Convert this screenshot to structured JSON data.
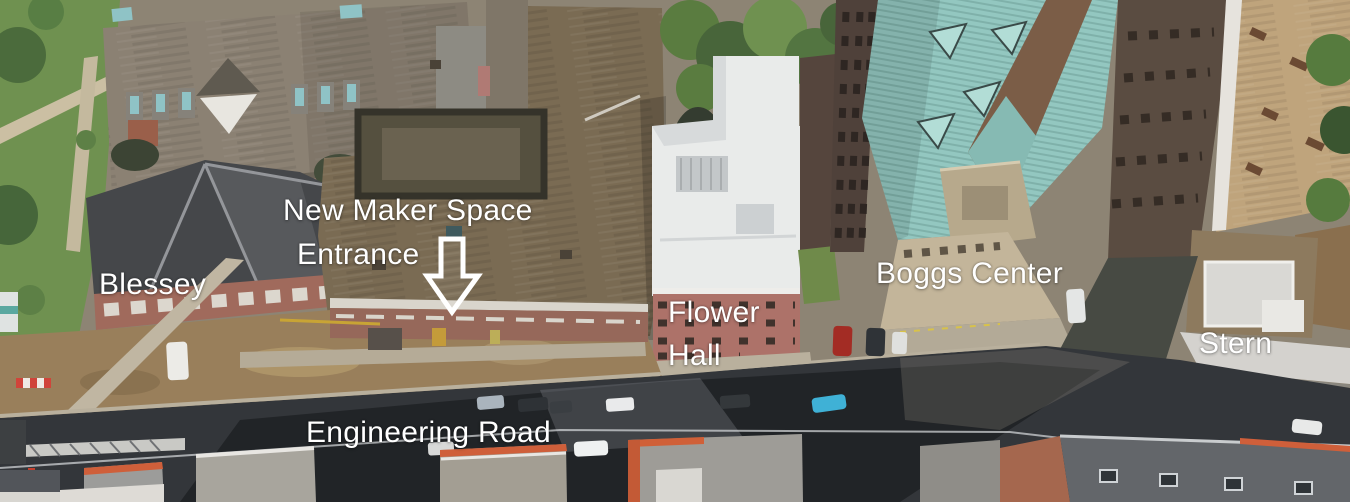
{
  "map": {
    "description": "Annotated aerial campus view showing the New Maker Space entrance",
    "annotations": {
      "maker_space_line1": "New Maker Space",
      "maker_space_line2": "Entrance",
      "blessey": "Blessey",
      "flower_line1": "Flower",
      "flower_line2": "Hall",
      "boggs": "Boggs Center",
      "stern": "Stern",
      "road": "Engineering Road"
    },
    "icons": {
      "entrance_arrow": "down-arrow-outline"
    },
    "colors": {
      "annotation_text": "#ffffff",
      "grass": "#6f9150",
      "tree": "#4b6b3c",
      "north_roof": "#8b8173",
      "blessey_roof": "#45474a",
      "maker_roof": "#7a6b53",
      "flower_roof": "#e9ebea",
      "flower_brick": "#ad7269",
      "boggs_roof": "#93c7c0",
      "stern_roof_tan": "#bfa47c",
      "stern_band": "#d4d2ce",
      "road_asphalt": "#33363a",
      "dirt": "#997f5b",
      "sidewalk": "#b5ab97",
      "south_roof_trim": "#cf5f3a"
    }
  }
}
